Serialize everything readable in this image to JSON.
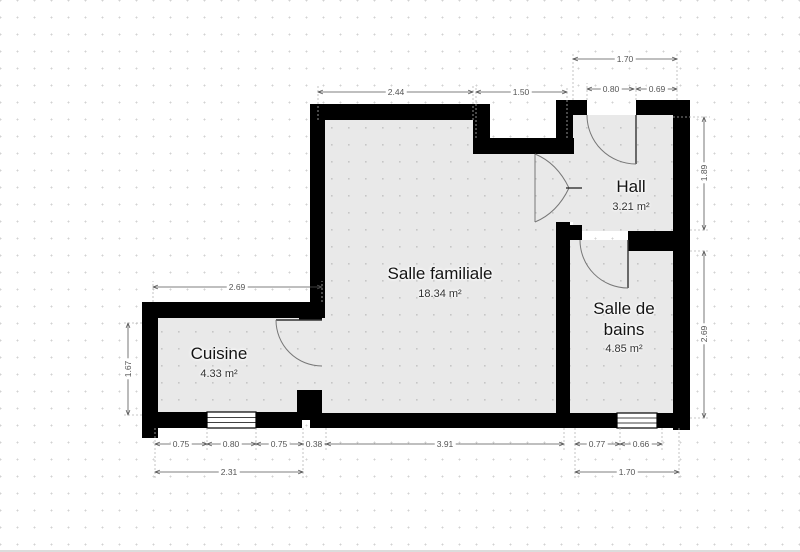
{
  "rooms": [
    {
      "id": "salle-familiale",
      "name": "Salle familiale",
      "area": "18.34 m²"
    },
    {
      "id": "hall",
      "name": "Hall",
      "area": "3.21 m²"
    },
    {
      "id": "salle-de-bains",
      "name": "Salle de bains",
      "area": "4.85 m²"
    },
    {
      "id": "cuisine",
      "name": "Cuisine",
      "area": "4.33 m²"
    }
  ],
  "dimensions": {
    "family_top_width": "2.44",
    "recess_width": "1.50",
    "hall_total_width": "1.70",
    "hall_door_width": "0.80",
    "hall_right_wall": "0.69",
    "hall_height": "1.89",
    "bath_height": "2.69",
    "cuisine_top_width": "2.69",
    "cuisine_height": "1.67",
    "cuisine_bottom_left": "0.75",
    "cuisine_window_width": "0.80",
    "cuisine_bottom_right": "0.75",
    "partition_width": "0.38",
    "family_bottom_width": "3.91",
    "bath_bottom_left": "0.77",
    "bath_window_width": "0.66",
    "cuisine_total_width": "2.31",
    "bath_total_width": "1.70"
  },
  "colors": {
    "wall": "#000000",
    "floor": "#e9e9e9",
    "dimension_text": "#555555",
    "room_text": "#141414"
  }
}
